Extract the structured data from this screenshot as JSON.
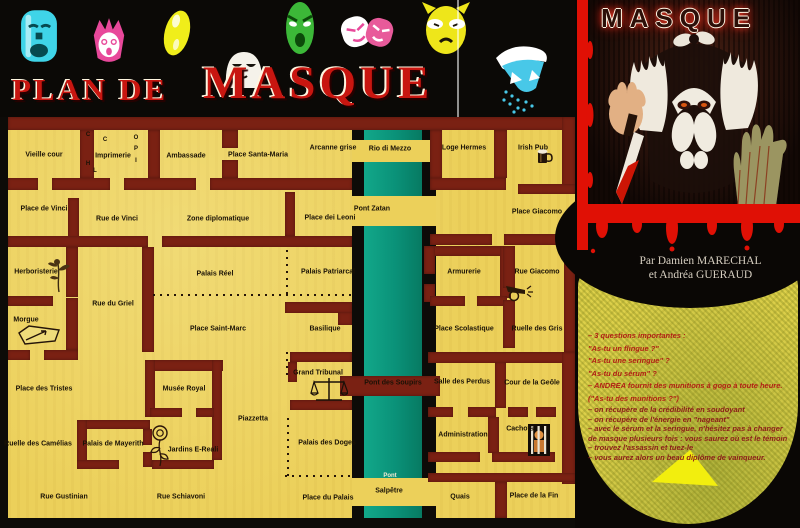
{
  "header": {
    "title_small": "PLAN DE",
    "title_large": "MASQUE",
    "masks": [
      {
        "name": "mask-sad-cyan",
        "color": "#3fd4e8"
      },
      {
        "name": "mask-crown-pink",
        "color": "#e8489a"
      },
      {
        "name": "mask-oval-yellow",
        "color": "#f0ee1a"
      },
      {
        "name": "mask-white",
        "color": "#f5f2ea"
      },
      {
        "name": "mask-green",
        "color": "#3cb838"
      },
      {
        "name": "mask-duo-pink",
        "color": "#e85a9a"
      },
      {
        "name": "mask-cat-yellow",
        "color": "#eee61a"
      },
      {
        "name": "mask-jester-cyan",
        "color": "#48c8e8"
      }
    ]
  },
  "map": {
    "colors": {
      "background": "#ecd05a",
      "wall": "#7a2113",
      "river": "#0a9178",
      "border": "#0d0b08"
    },
    "labels": [
      {
        "text": "Vieille cour",
        "x": 44,
        "y": 155
      },
      {
        "text": "Imprimerie",
        "x": 113,
        "y": 156
      },
      {
        "text": "Ambassade",
        "x": 186,
        "y": 156
      },
      {
        "text": "Place Santa-Maria",
        "x": 258,
        "y": 155
      },
      {
        "text": "Arcanne grise",
        "x": 333,
        "y": 148
      },
      {
        "text": "Rio di Mezzo",
        "x": 390,
        "y": 149
      },
      {
        "text": "Loge Hermes",
        "x": 464,
        "y": 148
      },
      {
        "text": "Irish Pub",
        "x": 533,
        "y": 148
      },
      {
        "text": "Place de Vinci",
        "x": 44,
        "y": 209
      },
      {
        "text": "Rue de Vinci",
        "x": 117,
        "y": 219
      },
      {
        "text": "Zone diplomatique",
        "x": 218,
        "y": 219
      },
      {
        "text": "Place dei Leoni",
        "x": 330,
        "y": 218
      },
      {
        "text": "Pont Zatan",
        "x": 372,
        "y": 209
      },
      {
        "text": "Place Giacomo",
        "x": 537,
        "y": 212
      },
      {
        "text": "Herboristerie",
        "x": 36,
        "y": 272
      },
      {
        "text": "Palais Réel",
        "x": 215,
        "y": 274
      },
      {
        "text": "Palais Patriarcal",
        "x": 328,
        "y": 272
      },
      {
        "text": "Armurerie",
        "x": 464,
        "y": 272
      },
      {
        "text": "Rue Giacomo",
        "x": 537,
        "y": 272
      },
      {
        "text": "Rue du Griel",
        "x": 113,
        "y": 304
      },
      {
        "text": "Morgue",
        "x": 26,
        "y": 320
      },
      {
        "text": "Place Saint-Marc",
        "x": 218,
        "y": 329
      },
      {
        "text": "Basilique",
        "x": 325,
        "y": 329
      },
      {
        "text": "Place Scolastique",
        "x": 464,
        "y": 329
      },
      {
        "text": "Ruelle des Gris",
        "x": 537,
        "y": 329
      },
      {
        "text": "Place des Tristes",
        "x": 44,
        "y": 389
      },
      {
        "text": "Musée Royal",
        "x": 184,
        "y": 389
      },
      {
        "text": "Grand Tribunal",
        "x": 318,
        "y": 373
      },
      {
        "text": "Pont des Soupirs",
        "x": 393,
        "y": 383
      },
      {
        "text": "Salle des Perdus",
        "x": 462,
        "y": 382
      },
      {
        "text": "Cour de la Geôle",
        "x": 532,
        "y": 383
      },
      {
        "text": "Piazzetta",
        "x": 253,
        "y": 419
      },
      {
        "text": "Administration",
        "x": 463,
        "y": 435
      },
      {
        "text": "Cachots",
        "x": 520,
        "y": 429
      },
      {
        "text": "Palais des Doges",
        "x": 327,
        "y": 443
      },
      {
        "text": "Ruelle des Camélias",
        "x": 38,
        "y": 444
      },
      {
        "text": "Palais de Mayerith",
        "x": 113,
        "y": 444
      },
      {
        "text": "Jardins E-Reali",
        "x": 193,
        "y": 450
      },
      {
        "text": "Rue Gustinian",
        "x": 64,
        "y": 497
      },
      {
        "text": "Rue Schiavoni",
        "x": 181,
        "y": 497
      },
      {
        "text": "Place du Palais",
        "x": 328,
        "y": 498
      },
      {
        "text": "Pont",
        "x": 390,
        "y": 476,
        "c": "#f2ead2",
        "s": 6
      },
      {
        "text": "Salpêtre",
        "x": 389,
        "y": 491
      },
      {
        "text": "Quais",
        "x": 460,
        "y": 497
      },
      {
        "text": "Place de la Fin",
        "x": 534,
        "y": 496
      },
      {
        "text": "C",
        "x": 88,
        "y": 135,
        "s": 6
      },
      {
        "text": "C",
        "x": 105,
        "y": 140,
        "s": 6
      },
      {
        "text": "O",
        "x": 136,
        "y": 138,
        "s": 6
      },
      {
        "text": "P",
        "x": 136,
        "y": 149,
        "s": 6
      },
      {
        "text": "I",
        "x": 136,
        "y": 161,
        "s": 6
      },
      {
        "text": "H",
        "x": 88,
        "y": 164,
        "s": 6
      },
      {
        "text": "L",
        "x": 95,
        "y": 171,
        "s": 6
      }
    ],
    "icons": [
      {
        "name": "herb-plant-icon"
      },
      {
        "name": "coffin-icon"
      },
      {
        "name": "scales-of-justice-icon"
      },
      {
        "name": "rose-icon"
      },
      {
        "name": "cannon-icon"
      },
      {
        "name": "jail-prisoner-icon"
      },
      {
        "name": "beer-mug-icon"
      }
    ]
  },
  "cover": {
    "title": "MASQUE"
  },
  "panel": {
    "authors_line1": "Par Damien MARECHAL",
    "authors_line2": "et Andréa GUERAUD",
    "lines": [
      "– 3 questions importantes :",
      "\"As-tu un flingue ?\"",
      "\"As-tu une seringue\" ?",
      "\"As-tu du sérum\" ?",
      "– ANDREA fournit des munitions à gogo à toute heure.",
      "(\"As-tu des munitions ?\")",
      "– on récupère de la crédibilité en soudoyant",
      "– on récupère de l'énergie en \"nageant\"",
      "– avec le sérum et la seringue, n'hésitez pas à changer",
      "de masque plusieurs fois : vous saurez où est le témoin",
      "– trouvez l'assassin et tuez-le",
      "– vous aurez alors un beau diplôme de vainqueur."
    ]
  },
  "colors": {
    "title_red": "#c81610",
    "frame_red": "#e01005",
    "panel_yellow": "#ddd04a",
    "hint_text": "#b22015",
    "arrow_yellow": "#f2ee0e"
  }
}
